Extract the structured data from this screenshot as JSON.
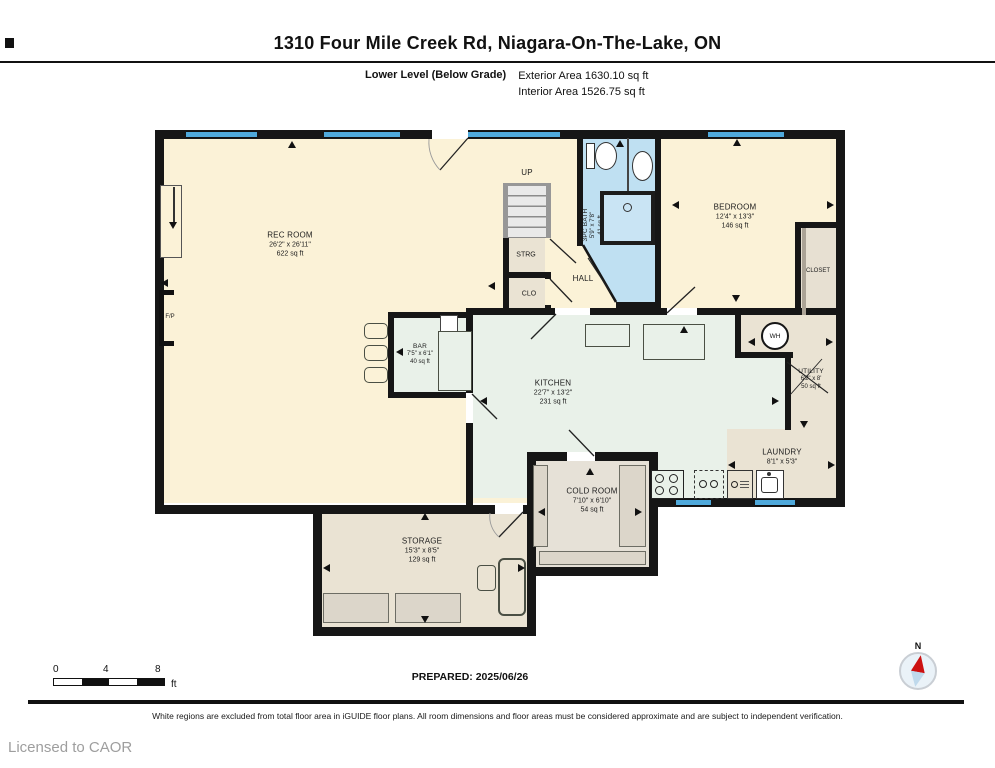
{
  "header": {
    "title": "1310 Four Mile Creek Rd, Niagara-On-The-Lake, ON",
    "level_label": "Lower Level (Below Grade)",
    "exterior_area": "Exterior Area 1630.10 sq ft",
    "interior_area": "Interior Area 1526.75 sq ft"
  },
  "rooms": {
    "rec_room": {
      "name": "REC ROOM",
      "dims": "26'2\" x 26'11\"",
      "area": "622 sq ft"
    },
    "bar": {
      "name": "BAR",
      "dims": "7'5\" x 6'1\"",
      "area": "40 sq ft"
    },
    "kitchen": {
      "name": "KITCHEN",
      "dims": "22'7\" x 13'2\"",
      "area": "231 sq ft"
    },
    "bath": {
      "name": "3PC BATH",
      "dims": "5'9\" x 7'8\"",
      "area": "41 sq ft"
    },
    "bedroom": {
      "name": "BEDROOM",
      "dims": "12'4\" x 13'3\"",
      "area": "146 sq ft"
    },
    "closet": {
      "name": "CLOSET"
    },
    "hall": {
      "name": "HALL"
    },
    "up": {
      "name": "UP"
    },
    "strg": {
      "name": "STRG"
    },
    "clo": {
      "name": "CLO"
    },
    "fp": {
      "name": "F/P"
    },
    "wh": {
      "name": "WH"
    },
    "utility": {
      "name": "UTILITY",
      "dims": "6'2\" x 8'",
      "area": "50 sq ft"
    },
    "laundry": {
      "name": "LAUNDRY",
      "dims": "8'1\" x 5'3\""
    },
    "cold_room": {
      "name": "COLD ROOM",
      "dims": "7'10\" x 6'10\"",
      "area": "54 sq ft"
    },
    "storage": {
      "name": "STORAGE",
      "dims": "15'3\" x 8'5\"",
      "area": "129 sq ft"
    }
  },
  "footer": {
    "scale_ticks": [
      "0",
      "4",
      "8"
    ],
    "scale_unit": "ft",
    "prepared": "PREPARED: 2025/06/26",
    "compass_label": "N",
    "disclaimer": "White regions are excluded from total floor area in iGUIDE floor plans. All room dimensions and floor areas must be considered approximate and are subject to independent verification.",
    "license": "Licensed to CAOR"
  },
  "colors": {
    "wall": "#161616",
    "window_blue": "#4FA9DB",
    "bath_blue": "#BFE0F2",
    "room_cream": "#FBF2D7",
    "kitchen_mint": "#E9F1E9",
    "storage_tan": "#EAE3D3"
  }
}
